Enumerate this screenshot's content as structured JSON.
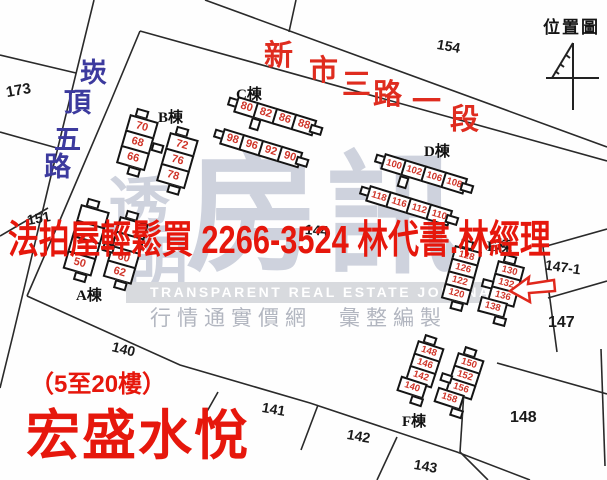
{
  "page_title": "位置圖",
  "overlay": {
    "ad": "法拍屋輕鬆買  2266-3524  林代書.林經理",
    "floors": "（5至20樓）",
    "project": "宏盛水悅",
    "color": "#e6170c"
  },
  "streets": {
    "left": {
      "name": "崁頂五路",
      "color": "#3c3a9e",
      "font_size": 27,
      "chars": [
        {
          "t": "崁",
          "x": 80,
          "y": 60
        },
        {
          "t": "頂",
          "x": 64,
          "y": 90
        },
        {
          "t": "五",
          "x": 54,
          "y": 127
        },
        {
          "t": "路",
          "x": 44,
          "y": 154
        }
      ]
    },
    "top": {
      "name": "新市三路一段",
      "color": "#df2c1f",
      "font_size": 29,
      "chars": [
        {
          "t": "新",
          "x": 264,
          "y": 42
        },
        {
          "t": "市",
          "x": 309,
          "y": 57
        },
        {
          "t": "三",
          "x": 342,
          "y": 71
        },
        {
          "t": "路",
          "x": 373,
          "y": 81
        },
        {
          "t": "一",
          "x": 412,
          "y": 88
        },
        {
          "t": "段",
          "x": 450,
          "y": 106
        }
      ]
    }
  },
  "lots": [
    {
      "label": "173",
      "x": 6,
      "y": 82,
      "rot": -10,
      "fs": 15
    },
    {
      "label": "151",
      "x": 27,
      "y": 210,
      "rot": -10,
      "fs": 14
    },
    {
      "label": "154",
      "x": 437,
      "y": 38,
      "rot": 10,
      "fs": 14
    },
    {
      "label": "144",
      "x": 305,
      "y": 222,
      "rot": 4,
      "fs": 14
    },
    {
      "label": "140",
      "x": 112,
      "y": 341,
      "rot": 14,
      "fs": 14
    },
    {
      "label": "141",
      "x": 262,
      "y": 401,
      "rot": 10,
      "fs": 14
    },
    {
      "label": "142",
      "x": 347,
      "y": 428,
      "rot": 10,
      "fs": 14
    },
    {
      "label": "143",
      "x": 414,
      "y": 458,
      "rot": 10,
      "fs": 14
    },
    {
      "label": "147-1",
      "x": 545,
      "y": 259,
      "rot": 8,
      "fs": 14
    },
    {
      "label": "147",
      "x": 548,
      "y": 314,
      "rot": 0,
      "fs": 16
    },
    {
      "label": "148",
      "x": 510,
      "y": 409,
      "rot": 0,
      "fs": 16
    }
  ],
  "buildings": [
    {
      "name": "A",
      "label": "A棟",
      "lx": 76,
      "ly": 284,
      "wings": [
        {
          "x": 81,
          "y": 204,
          "rot": 16,
          "dir": "v",
          "w": 30,
          "h": 19,
          "cells": [
            {
              "n": ""
            },
            {
              "n": ""
            },
            {
              "n": ""
            },
            {
              "n": "50"
            }
          ]
        },
        {
          "x": 120,
          "y": 216,
          "rot": 16,
          "dir": "v",
          "w": 30,
          "h": 18,
          "cells": [
            {
              "n": ""
            },
            {
              "n": ""
            },
            {
              "n": "60"
            },
            {
              "n": "62"
            }
          ]
        }
      ],
      "connectors": [
        {
          "x": 104,
          "y": 242,
          "w": 12,
          "h": 9,
          "rot": 16
        }
      ]
    },
    {
      "name": "B",
      "label": "B棟",
      "lx": 158,
      "ly": 106,
      "wings": [
        {
          "x": 130,
          "y": 114,
          "rot": 16,
          "dir": "v",
          "w": 30,
          "h": 19,
          "cells": [
            {
              "n": "70"
            },
            {
              "n": "68"
            },
            {
              "n": "66"
            }
          ]
        },
        {
          "x": 170,
          "y": 132,
          "rot": 16,
          "dir": "v",
          "w": 30,
          "h": 19,
          "cells": [
            {
              "n": "72"
            },
            {
              "n": "76"
            },
            {
              "n": "78"
            }
          ]
        }
      ],
      "connectors": [
        {
          "x": 153,
          "y": 142,
          "w": 12,
          "h": 9,
          "rot": 16
        }
      ]
    },
    {
      "name": "C",
      "label": "C棟",
      "lx": 236,
      "ly": 83,
      "wings": [
        {
          "x": 238,
          "y": 96,
          "rot": 17,
          "dir": "h",
          "w": 23,
          "h": 17,
          "cells": [
            {
              "n": "80"
            },
            {
              "n": "82"
            },
            {
              "n": "86"
            },
            {
              "n": "88"
            }
          ]
        },
        {
          "x": 224,
          "y": 128,
          "rot": 17,
          "dir": "h",
          "w": 23,
          "h": 17,
          "cells": [
            {
              "n": "98"
            },
            {
              "n": "96"
            },
            {
              "n": "92"
            },
            {
              "n": "90"
            }
          ]
        }
      ],
      "connectors": [
        {
          "x": 252,
          "y": 117,
          "w": 10,
          "h": 12,
          "rot": 17
        }
      ]
    },
    {
      "name": "D",
      "label": "D棟",
      "lx": 424,
      "ly": 140,
      "wings": [
        {
          "x": 385,
          "y": 153,
          "rot": 17,
          "dir": "h",
          "w": 24,
          "h": 17,
          "cells": [
            {
              "n": "100"
            },
            {
              "n": "102"
            },
            {
              "n": "106"
            },
            {
              "n": "108"
            }
          ]
        },
        {
          "x": 370,
          "y": 185,
          "rot": 17,
          "dir": "h",
          "w": 24,
          "h": 17,
          "cells": [
            {
              "n": "118"
            },
            {
              "n": "116"
            },
            {
              "n": "112"
            },
            {
              "n": "110"
            }
          ]
        }
      ],
      "connectors": [
        {
          "x": 400,
          "y": 175,
          "w": 10,
          "h": 12,
          "rot": 17
        }
      ]
    },
    {
      "name": "E",
      "label": "E棟",
      "lx": 487,
      "ly": 235,
      "wings": [
        {
          "x": 455,
          "y": 245,
          "rot": 15,
          "dir": "v",
          "w": 28,
          "h": 16,
          "cells": [
            {
              "n": "128"
            },
            {
              "n": "126"
            },
            {
              "n": "122"
            },
            {
              "n": "120"
            }
          ]
        },
        {
          "x": 498,
          "y": 260,
          "rot": 15,
          "dir": "v",
          "w": 28,
          "h": 16,
          "cells": [
            {
              "n": "130"
            },
            {
              "n": "132"
            },
            {
              "n": "136"
            },
            {
              "n": "138",
              "dx": -7
            }
          ]
        }
      ],
      "connectors": [
        {
          "x": 483,
          "y": 278,
          "w": 12,
          "h": 9,
          "rot": 15
        }
      ]
    },
    {
      "name": "F",
      "label": "F棟",
      "lx": 402,
      "ly": 410,
      "wings": [
        {
          "x": 418,
          "y": 340,
          "rot": 18,
          "dir": "v",
          "w": 28,
          "h": 16,
          "cells": [
            {
              "n": "148"
            },
            {
              "n": "146"
            },
            {
              "n": "142"
            },
            {
              "n": "140",
              "dx": -5
            }
          ]
        },
        {
          "x": 458,
          "y": 352,
          "rot": 18,
          "dir": "v",
          "w": 28,
          "h": 16,
          "cells": [
            {
              "n": "150"
            },
            {
              "n": "152"
            },
            {
              "n": "156"
            },
            {
              "n": "158",
              "dx": -8
            }
          ]
        }
      ],
      "connectors": [
        {
          "x": 442,
          "y": 372,
          "w": 12,
          "h": 9,
          "rot": 18
        }
      ]
    }
  ],
  "map_lines": [
    {
      "id": "road-left-west-edge",
      "pts": "94,0 50,180 13,335 0,388"
    },
    {
      "id": "road-left-east-edge",
      "pts": "140,31 110,103 60,220 27,296"
    },
    {
      "id": "road-top-north-edge",
      "pts": "205,0 607,147"
    },
    {
      "id": "road-top-tick",
      "pts": "296,0 289,32"
    },
    {
      "id": "road-top-south-edge",
      "pts": "140,31 413,107 607,161"
    },
    {
      "id": "left-parcel-line-1",
      "pts": "0,55 76,73"
    },
    {
      "id": "left-parcel-line-2",
      "pts": "0,132 57,148"
    },
    {
      "id": "left-parcel-line-3",
      "pts": "0,236 48,208"
    },
    {
      "id": "bottom-boundary",
      "pts": "27,296 180,365 310,403 457,452 530,480"
    },
    {
      "id": "div-140-141",
      "pts": "218,392 205,415"
    },
    {
      "id": "div-141-142",
      "pts": "318,405 301,450"
    },
    {
      "id": "div-142-143",
      "pts": "397,437 377,480"
    },
    {
      "id": "div-143-right",
      "pts": "460,452 488,480"
    },
    {
      "id": "div-148-143",
      "pts": "464,391 460,452"
    },
    {
      "id": "lot147-1-top",
      "pts": "543,247 607,229"
    },
    {
      "id": "lot147-1-147",
      "pts": "548,298 607,281"
    },
    {
      "id": "site-right-edge",
      "pts": "543,247 557,352"
    },
    {
      "id": "div-147-148",
      "pts": "497,363 607,394"
    },
    {
      "id": "right-margin-line",
      "pts": "601,349 605,466"
    }
  ],
  "north_arrow": {
    "segments": [
      {
        "pts": "573,43 573,110"
      },
      {
        "pts": "573,43 552,78"
      },
      {
        "pts": "546,78 599,78"
      },
      {
        "pts": "566,55 570,58"
      },
      {
        "pts": "560,64 564,67"
      },
      {
        "pts": "555,71 559,74"
      }
    ]
  },
  "annotation_arrow": {
    "points": "510,291 529,277 528,284 554,280 555,291 529,293 530,302",
    "color": "#e0281c"
  },
  "watermark": {
    "chars": [
      {
        "t": "透",
        "x": 108,
        "y": 176,
        "fs": 62
      },
      {
        "t": "明",
        "x": 126,
        "y": 236,
        "fs": 62
      },
      {
        "t": "房",
        "x": 186,
        "y": 148,
        "fs": 132
      },
      {
        "t": "訊",
        "x": 326,
        "y": 150,
        "fs": 132
      }
    ],
    "band": "TRANSPARENT REAL ESTATE JOURNAL",
    "sub": "行情通實價網　彙整編製"
  }
}
